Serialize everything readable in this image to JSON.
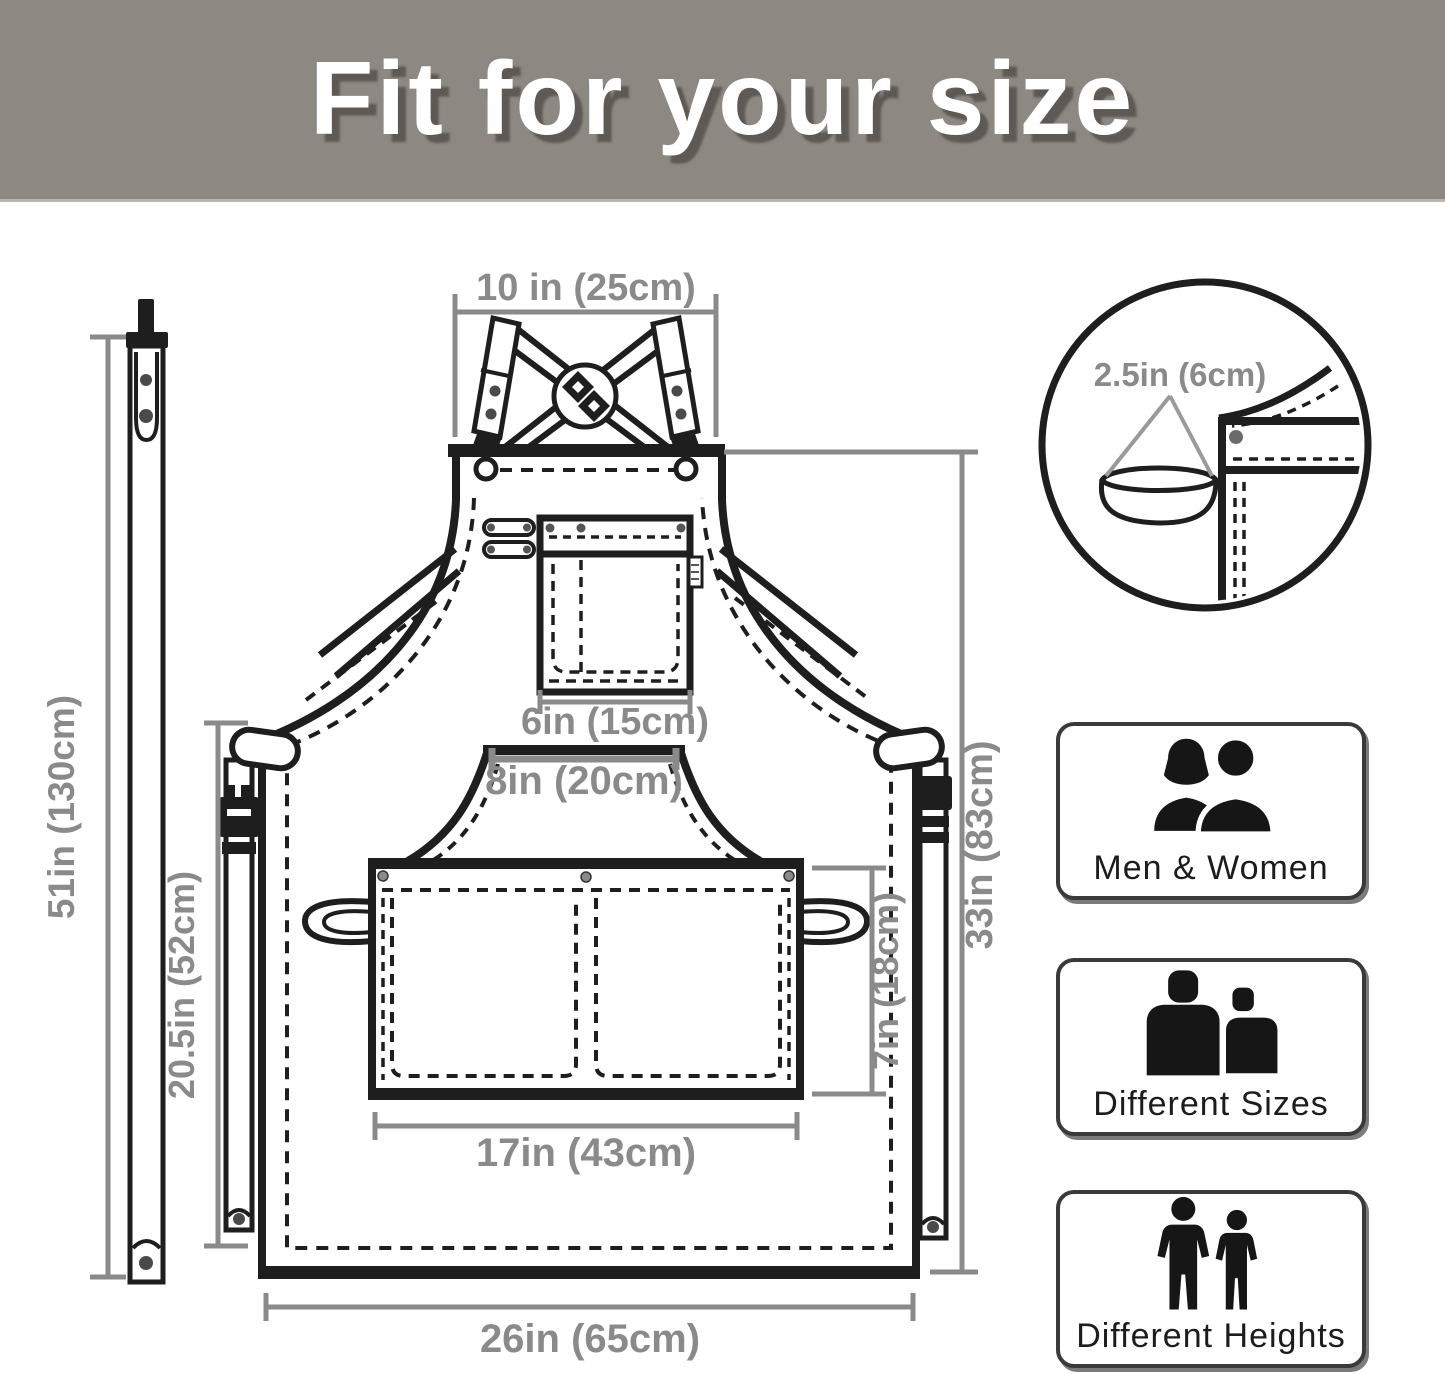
{
  "header": {
    "title": "Fit for your size"
  },
  "dims": {
    "neck_width": "10 in (25cm)",
    "strap_length": "51in (130cm)",
    "side_length": "20.5in (52cm)",
    "chest_pocket_width": "6in (15cm)",
    "waist_panel_width": "8in (20cm)",
    "pocket_width": "17in (43cm)",
    "pocket_height": "7in (18cm)",
    "body_length": "33in (83cm)",
    "bottom_width": "26in (65cm)",
    "loop_size": "2.5in (6cm)"
  },
  "features": [
    {
      "label": "Men & Women",
      "icon": "men-women-icon"
    },
    {
      "label": "Different Sizes",
      "icon": "different-sizes-icon"
    },
    {
      "label": "Different Heights",
      "icon": "different-heights-icon"
    }
  ],
  "colors": {
    "header_bg": "#8d8881",
    "header_text": "#ffffff",
    "line_black": "#1e1e1e",
    "dim_gray": "#8a8a8a"
  }
}
